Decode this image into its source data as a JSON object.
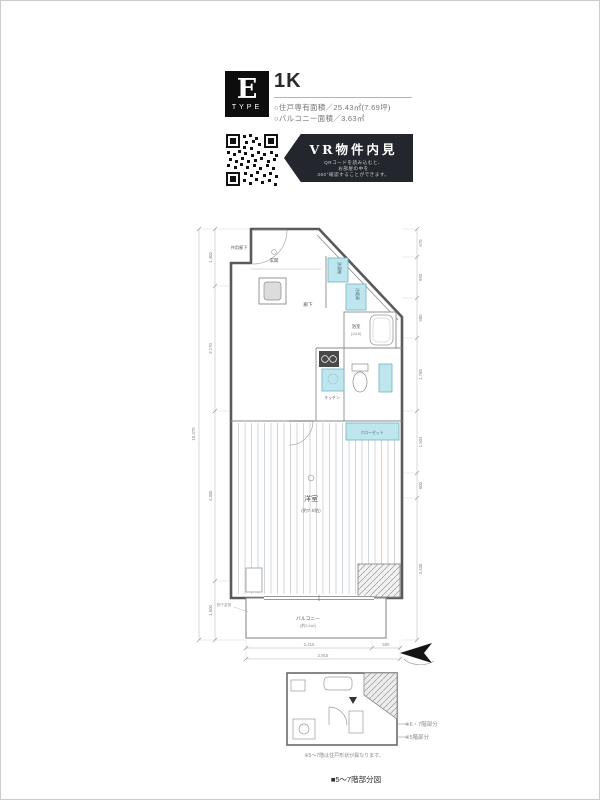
{
  "header": {
    "type_letter": "E",
    "type_word": "TYPE",
    "plan_type": "1K",
    "area_line": "○住戸専有面積／25.43㎡(7.69坪)",
    "balcony_line": "○バルコニー面積／3.63㎡"
  },
  "vr": {
    "title": "VR物件内見",
    "sub1": "QRコードを読み込むと、",
    "sub2": "お部屋の中を",
    "sub3": "360°確認することができます。"
  },
  "plan": {
    "labels": {
      "corridor": "共用廊下",
      "entrance": "玄関",
      "hallway": "廊下",
      "washer": "洗濯機",
      "fridge": "冷蔵庫",
      "bathroom": "浴室",
      "bathroom_size": "(1116)",
      "kitchen": "キッチン",
      "closet": "クローゼット",
      "room": "洋室",
      "room_size": "(約7.5帖)",
      "balcony": "バルコニー",
      "balcony_size": "(約3.6㎡)",
      "pole": "物干金物"
    },
    "dims": {
      "left_total": "10,370",
      "left_segments": [
        "1,400",
        "3,170",
        "4,300",
        "1,500"
      ],
      "right_segments": [
        "670",
        "990",
        "980",
        "1,780",
        "1,503",
        "600",
        "3,430"
      ],
      "bottom_segments": [
        "2,415",
        "500"
      ],
      "bottom_total": "2,915"
    }
  },
  "sub_plan": {
    "callout1": "※6・7階部分",
    "callout2": "※5階部分",
    "note": "※5〜7階は住戸形状が異なります。",
    "caption": "■5〜7階部分図"
  },
  "colors": {
    "accent_cyan": "#bfe6ee",
    "banner_bg": "#23272d"
  }
}
